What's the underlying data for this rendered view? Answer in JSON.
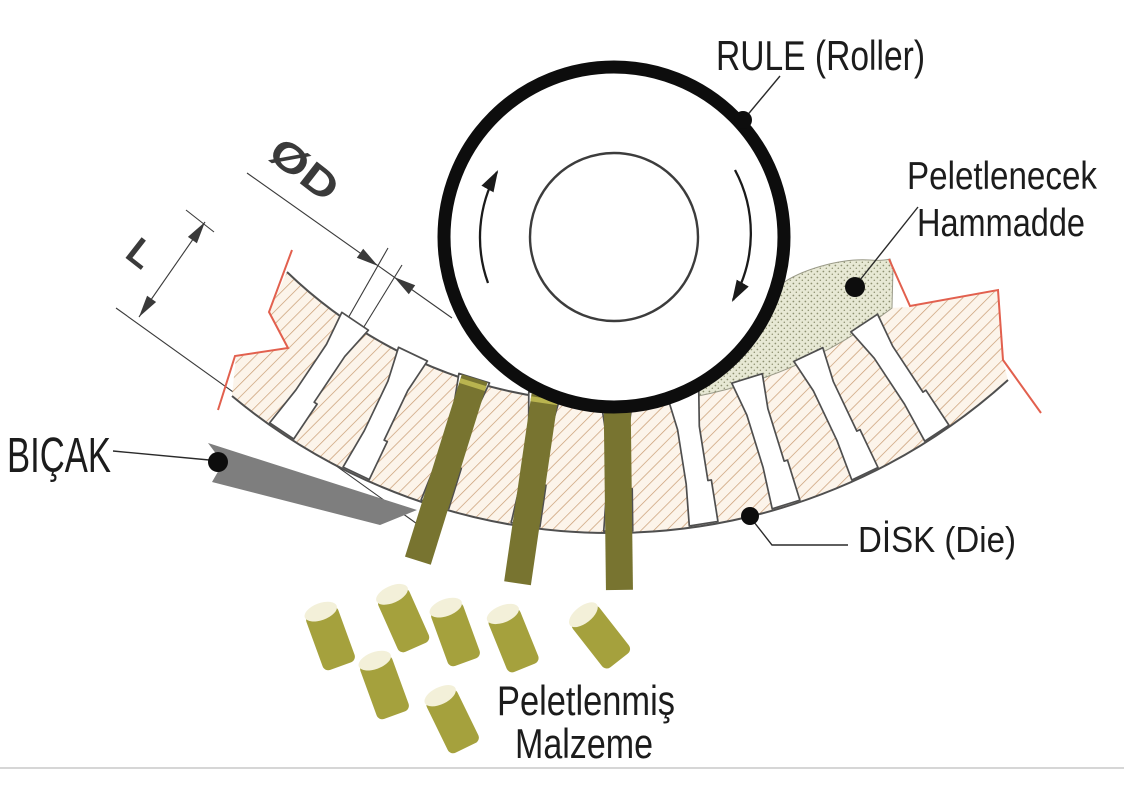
{
  "diagram": {
    "labels": {
      "roller": "RULE (Roller)",
      "raw_material_line1": "Peletlenecek",
      "raw_material_line2": "Hammadde",
      "knife": "BIÇAK",
      "die": "DİSK (Die)",
      "pellets_line1": "Peletlenmiş",
      "pellets_line2": "Malzeme",
      "dim_diameter": "ØD",
      "dim_length": "L"
    },
    "colors": {
      "pellet_strand": "#787430",
      "pellet_body": "#a5a13d",
      "pellet_top": "#f3f0d9",
      "pellet_top_stroke": "#8e8a38",
      "knife": "#7e7e7e",
      "break_line": "#e2604e",
      "hatch_line": "#c89b71",
      "hatch_bg": "#fcf4ea",
      "stipple_bg": "#e7e8d4",
      "stipple_dot": "#8e9171",
      "outline": "#4f4f4f",
      "roller_ring": "#0d0d0d",
      "leader": "#2a2a2a",
      "scan_line": "#c9c9c9"
    }
  }
}
